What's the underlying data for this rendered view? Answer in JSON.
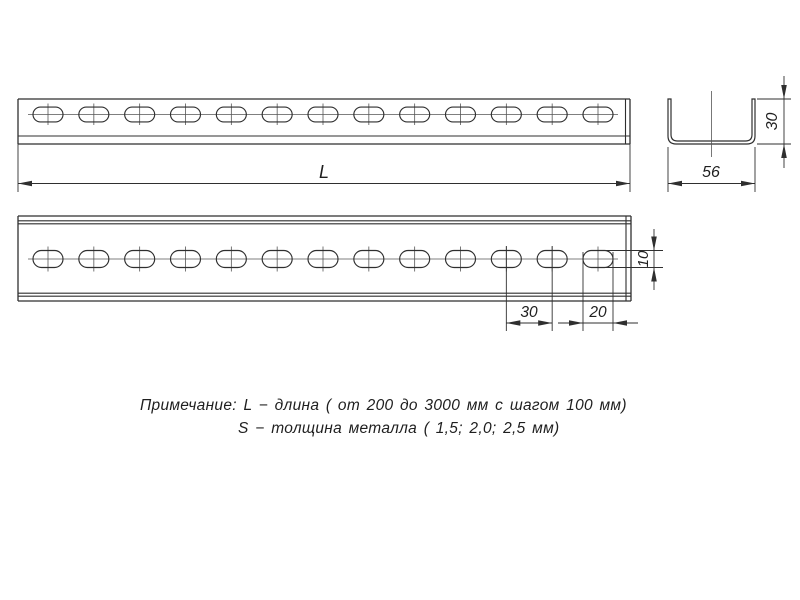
{
  "drawing": {
    "dims": {
      "length": "L",
      "section_width": "56",
      "section_height": "30",
      "hole_height": "10",
      "hole_pitch": "30",
      "slot_length": "20"
    },
    "notes": {
      "line1": "Примечание: L − длина ( от 200 до 3000 мм с шагом 100 мм)",
      "line2": "S − толщина металла ( 1,5; 2,0; 2,5 мм)"
    },
    "views": {
      "side_view_holes_count": 13,
      "plan_view_holes_count": 13
    },
    "colors": {
      "line": "#2f2f2f",
      "centerline": "#555555",
      "background": "#ffffff",
      "text": "#1f1f1f"
    }
  }
}
